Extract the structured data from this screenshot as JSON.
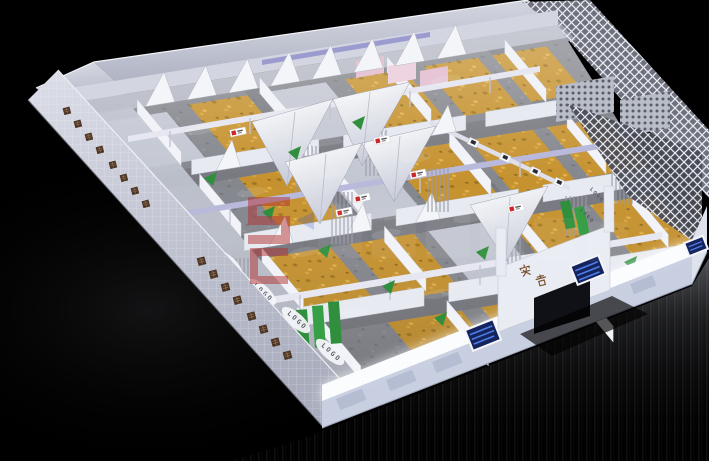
{
  "scene": {
    "type": "3d-exhibition-hall-render",
    "view": "aerial-isometric",
    "background_color": "#000000"
  },
  "texts": {
    "roof_banner": "安吉",
    "entrance_sign": "安吉",
    "booth_header": "LOGO"
  },
  "palette": {
    "back_wall": "#c6c9d4",
    "lattice_line": "#e9ebf2",
    "carpet": "#85878e",
    "booth_floor_gold": "#c79330",
    "partition_white": "#eef0f5",
    "accent_green": "#2f8f3c",
    "beam_lavender": "#b9badb",
    "screen_blue": "#16245e",
    "screen_frame": "#f4f6fa",
    "sign_red": "#cc2727",
    "wall_character_brown": "#4a3424",
    "entrance_text_brown": "#7a5434",
    "banner_bg": "#30313a",
    "watermark_red": "#b23333"
  },
  "counts": {
    "booth_header_labels": 10,
    "canopy_sails": 5,
    "triangular_fins": 15,
    "blue_screens": 3,
    "red_signs": 6,
    "wall_character_blocks": 16
  }
}
